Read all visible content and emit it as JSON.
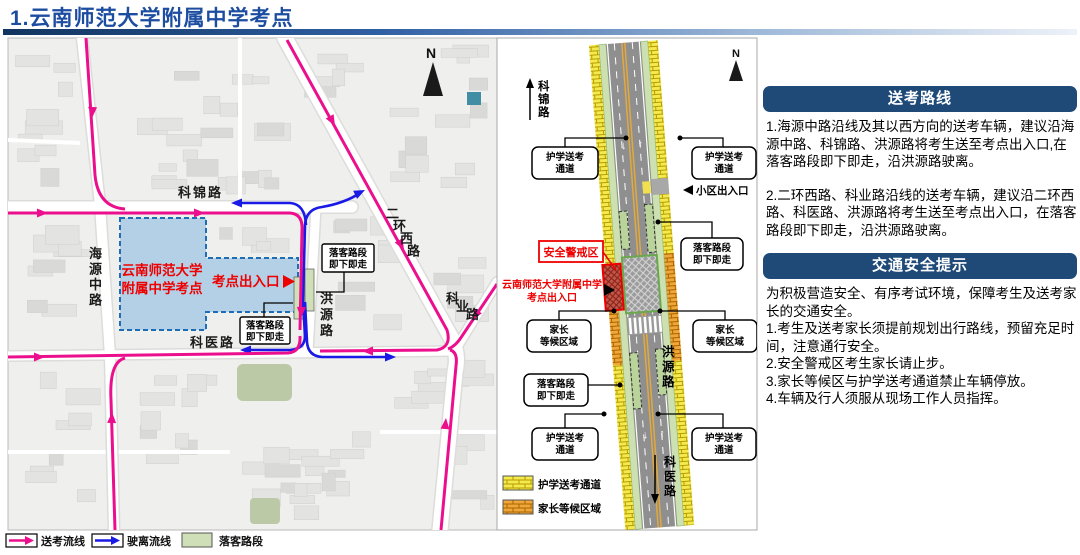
{
  "page": {
    "title": "1.云南师范大学附属中学考点"
  },
  "map": {
    "compass": "N",
    "roads": {
      "kejinlu": "科锦路",
      "haiyuanzhonglu": "海源中路",
      "keyilu": "科医路",
      "hongyuanlu": "洪源路",
      "erhuanxilu": "二环西路",
      "keyelu": "科业路"
    },
    "campus": {
      "line1": "云南师范大学",
      "line2": "附属中学考点"
    },
    "entrance": "考点出入口",
    "dropoff": {
      "line1": "落客路段",
      "line2": "即下即走"
    },
    "legend": {
      "songkao": "送考流线",
      "shili": "驶离流线",
      "luoke": "落客路段"
    }
  },
  "diagram": {
    "compass": "N",
    "escort": {
      "line1": "护学送考",
      "line2": "通道"
    },
    "community": "小区出入口",
    "dropoff": {
      "line1": "落客路段",
      "line2": "即下即走"
    },
    "security": "安全警戒区",
    "school": {
      "line1": "云南师范大学附属中学",
      "line2": "考点出入口"
    },
    "parents": {
      "line1": "家长",
      "line2": "等候区域"
    },
    "roads": {
      "kejinlu": "科锦路",
      "hongyuanlu": "洪源路",
      "keyilu": "科医路"
    },
    "legend": {
      "escort": "护学送考通道",
      "parents": "家长等候区域"
    }
  },
  "panel": {
    "sections": [
      {
        "title": "送考路线",
        "paragraphs": [
          "1.海源中路沿线及其以西方向的送考车辆，建议沿海源中路、科锦路、洪源路将考生送至考点出入口,在落客路段即下即走，沿洪源路驶离。",
          "2.二环西路、科业路沿线的送考车辆，建议沿二环西路、科医路、洪源路将考生送至考点出入口，在落客路段即下即走，沿洪源路驶离。"
        ]
      },
      {
        "title": "交通安全提示",
        "paragraphs": [
          "为积极营造安全、有序考试环境，保障考生及送考家长的交通安全。",
          "1.考生及送考家长须提前规划出行路线，预留充足时间，注意通行安全。",
          "2.安全警戒区考生家长请止步。",
          "3.家长等候区与护学送考通道禁止车辆停放。",
          "4.车辆及行人须服从现场工作人员指挥。"
        ]
      }
    ]
  },
  "colors": {
    "title_blue": "#1c4da0",
    "header_navy": "#1f4a78",
    "route_pink": "#ec0f8d",
    "route_blue": "#1a1ae6",
    "alert_red": "#ee0000",
    "campus_fill": "#b3d0e6",
    "campus_border": "#1f6eb5",
    "dropoff_green": "#cfe0b8",
    "escort_yellow": "#f2ea4e",
    "parents_orange": "#f0a73a"
  }
}
